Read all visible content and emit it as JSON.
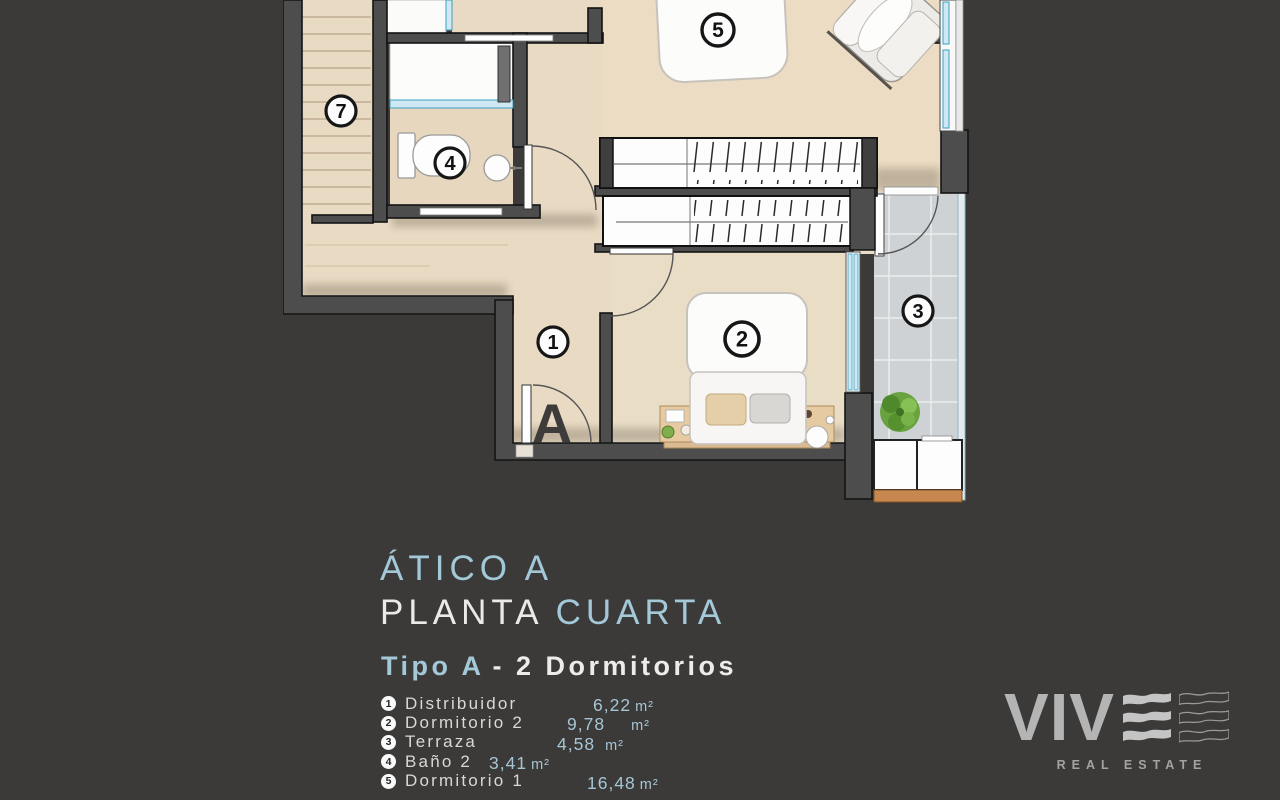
{
  "title": {
    "line1": "ÁTICO A",
    "line2_word": "PLANTA",
    "line2_accent": "CUARTA"
  },
  "type_heading": {
    "accent": "Tipo A",
    "rest": "- 2 Dormitorios"
  },
  "legend": {
    "items": [
      {
        "num": "1",
        "name": "Distribuidor",
        "area": "6,22",
        "unit": "m²"
      },
      {
        "num": "2",
        "name": "Dormitorio 2",
        "area": "9,78",
        "unit": "m²"
      },
      {
        "num": "3",
        "name": "Terraza",
        "area": "4,58",
        "unit": "m²"
      },
      {
        "num": "4",
        "name": "Baño 2",
        "area": "3,41",
        "unit": "m²"
      },
      {
        "num": "5",
        "name": "Dormitorio 1",
        "area": "16,48",
        "unit": "m²"
      }
    ]
  },
  "plan": {
    "unit_letter": "A",
    "labels": [
      {
        "room": "distribuidor",
        "n": "1"
      },
      {
        "room": "dormitorio-2",
        "n": "2"
      },
      {
        "room": "terraza",
        "n": "3"
      },
      {
        "room": "bano-2",
        "n": "4"
      },
      {
        "room": "dormitorio-1",
        "n": "5"
      },
      {
        "room": "escalera",
        "n": "7"
      }
    ]
  },
  "logo": {
    "word": "VIV",
    "tagline": "REAL ESTATE"
  },
  "colors": {
    "accent": "#a3c8d8",
    "background": "#3b3a39",
    "floor": "#e9dac3",
    "glass": "#3e9fc0",
    "wood": "#c8874e",
    "terrace_tile": "#cfd2d5"
  }
}
